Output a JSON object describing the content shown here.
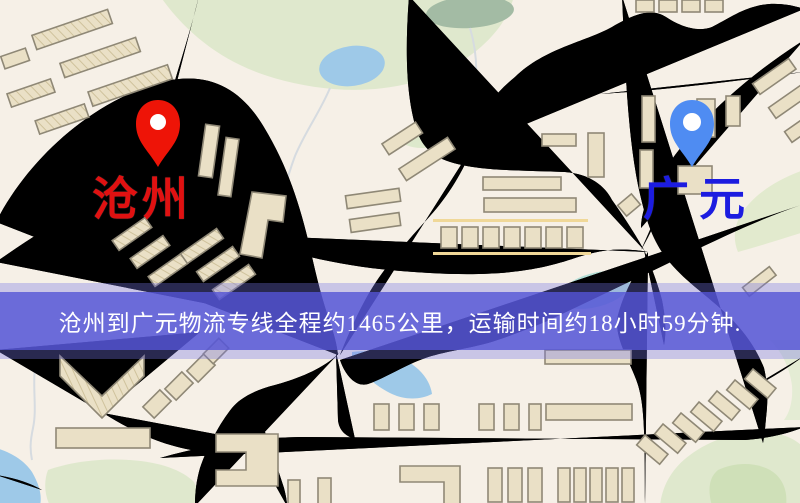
{
  "banner": {
    "text": "沧州到广元物流专线全程约1465公里，运输时间约18小时59分钟."
  },
  "route": {
    "origin_city": "沧州",
    "destination_city": "广元",
    "service": "物流专线",
    "distance_km": "1465",
    "duration": "18小时59分钟"
  },
  "markers": {
    "origin": {
      "name": "沧州",
      "icon": "map-pin-icon",
      "pin_color": "#ee1407",
      "label_color": "#e01111"
    },
    "destination": {
      "name": "广元",
      "icon": "map-pin-icon",
      "pin_color": "#4f8cf2",
      "label_color": "#1c1ce0"
    }
  },
  "map": {
    "colors": {
      "background": "#f6f0e7",
      "road_fill": "#f8d77e",
      "road_casing": "#e2b65c",
      "railway": "#2b2b34",
      "water": "#9ec9e8",
      "park": "#dfe8cd",
      "building": "#eae0c6",
      "banner_overlay": "#5454d6",
      "banner_text": "#ffffff"
    }
  }
}
